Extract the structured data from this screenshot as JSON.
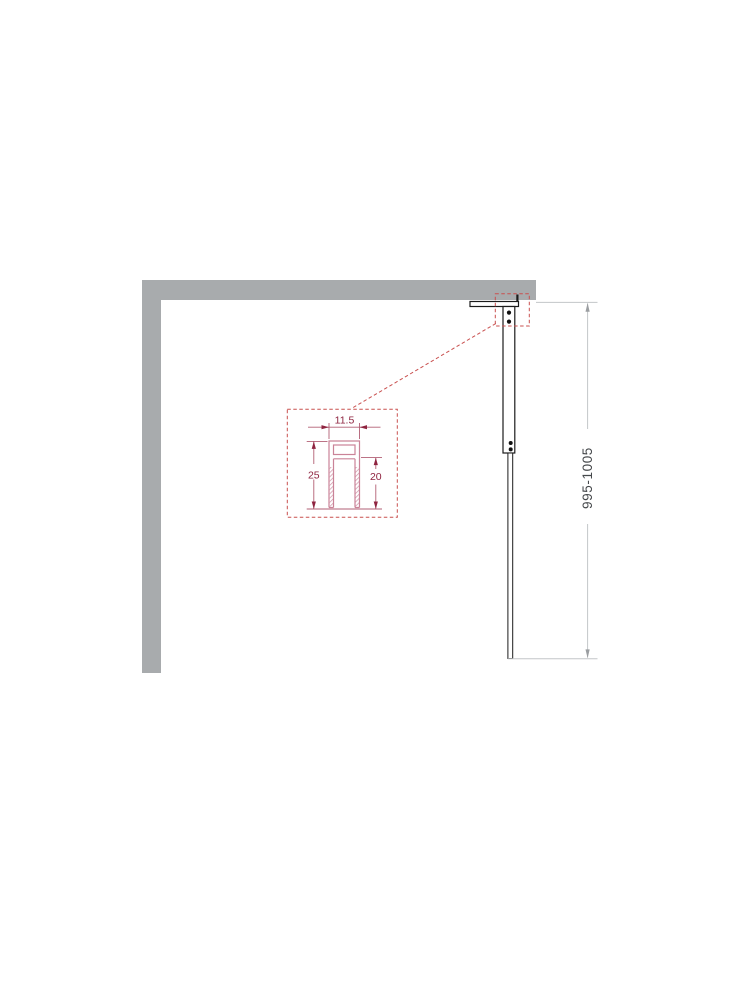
{
  "diagram": {
    "walls": {
      "fill_color": "#a8abad"
    },
    "panel": {
      "outline_color": "#1b1b1b",
      "screw_count": 4
    },
    "callout": {
      "box_color": "#c9504f",
      "profile_outline_color": "#ca8398",
      "dimension_color": "#8f2440",
      "labels": {
        "profile_width": "11.5",
        "profile_height": "25",
        "profile_slot_depth": "20"
      }
    },
    "height_dimension": {
      "label": "995-1005",
      "line_color": "#c3c6c8",
      "arrow_color": "#9b9ea1",
      "text_color": "#46494c"
    }
  }
}
